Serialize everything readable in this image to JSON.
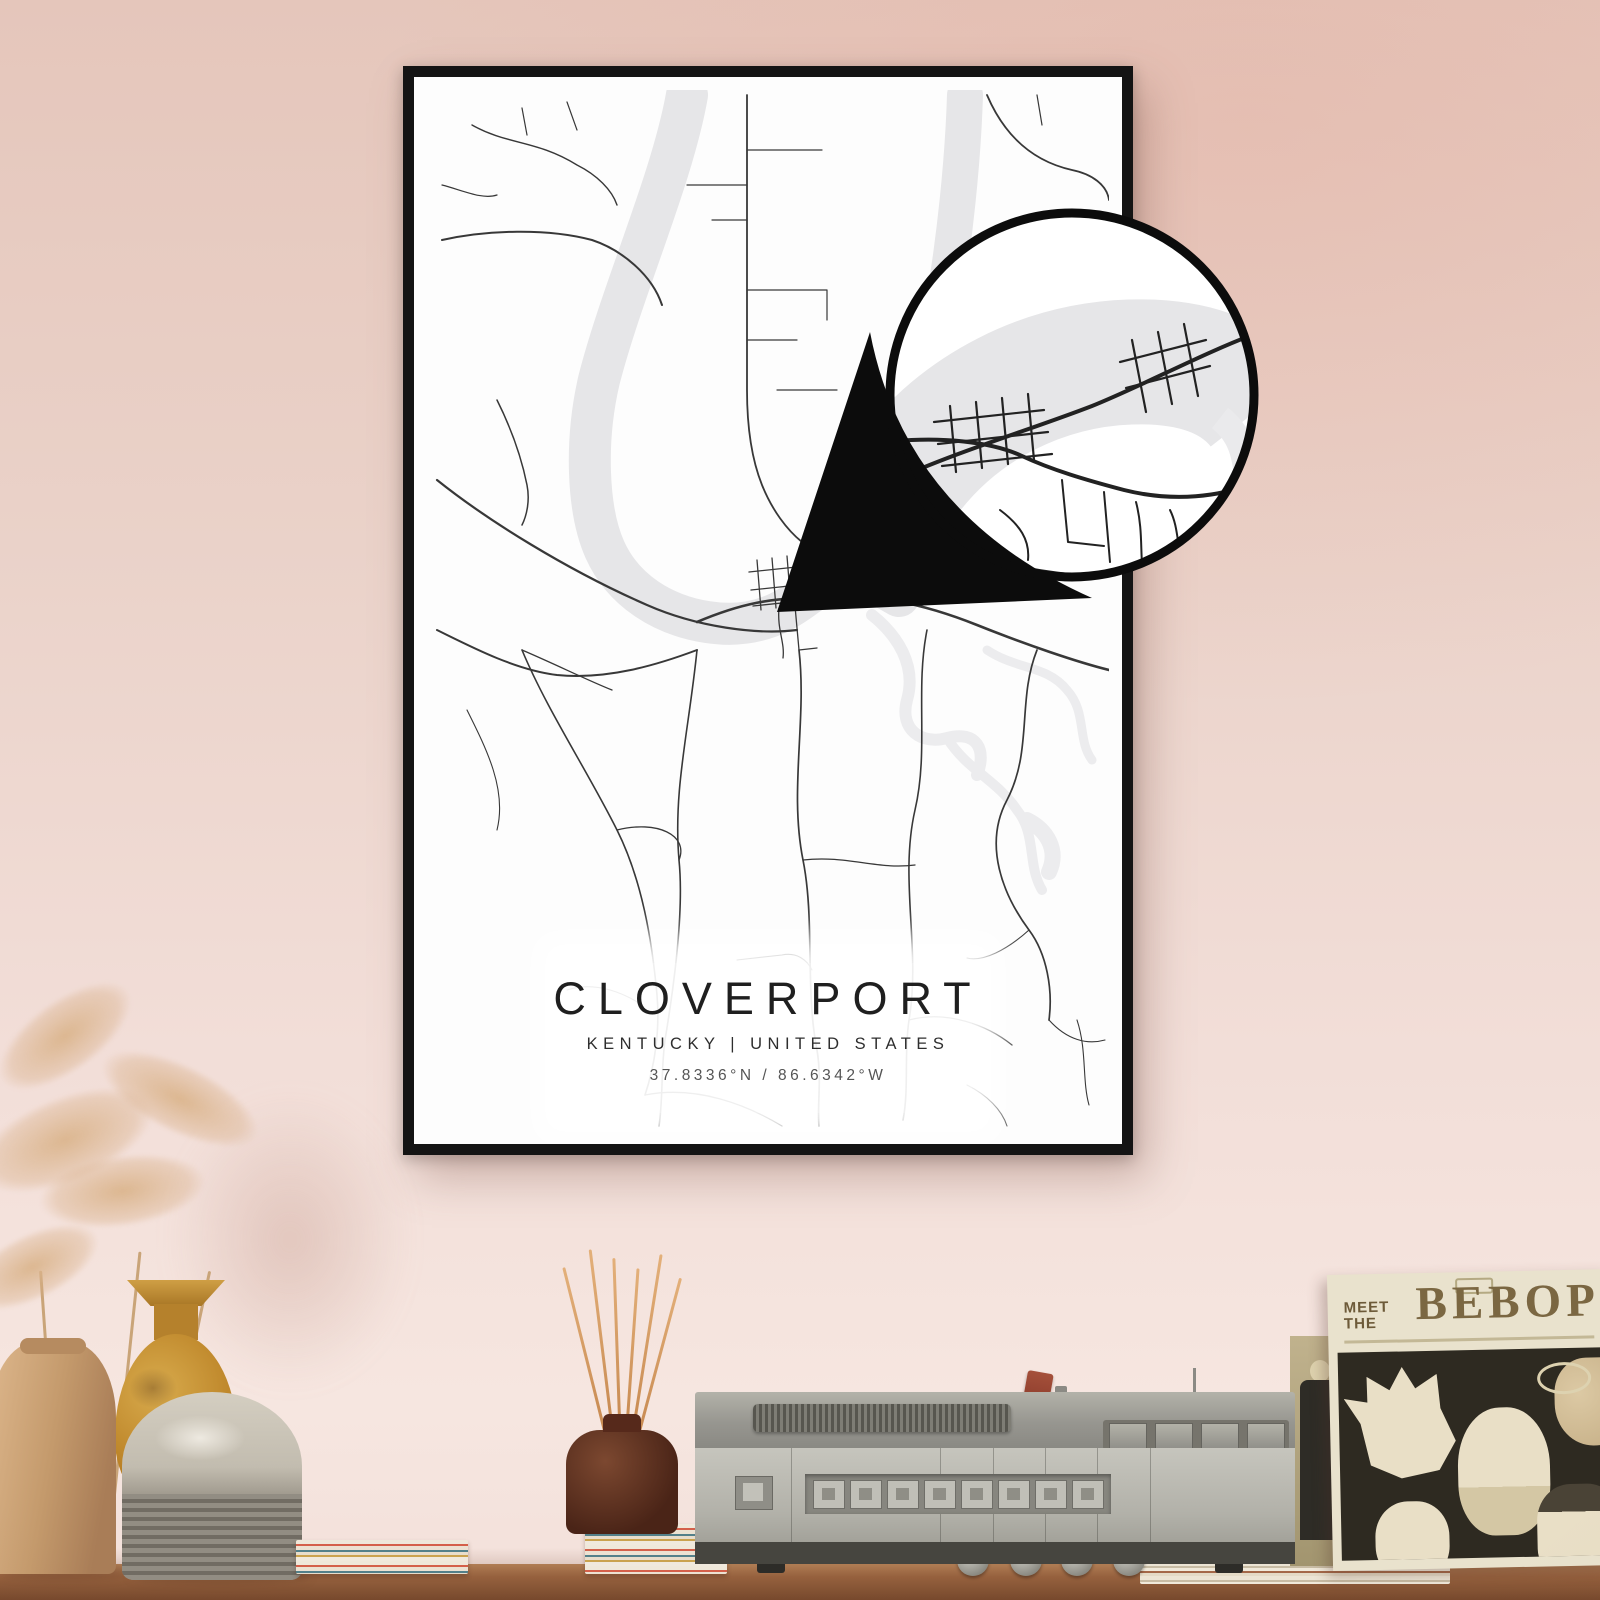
{
  "poster": {
    "title": "CLOVERPORT",
    "subtitle": "KENTUCKY | UNITED STATES",
    "coordinates": "37.8336°N / 86.6342°W"
  },
  "sleeve": {
    "meet": "MEET",
    "the": "THE",
    "bebop": "BEBOP"
  },
  "colors": {
    "wall": "#e9cec4",
    "frame": "#141414",
    "map_water": "#e6e6e8",
    "map_road": "#353535",
    "table_wood": "#96613e",
    "cartridge_red": "#9c4531",
    "sleeve_cream": "#e9e2cd",
    "sleeve_art_dark": "#2e2a21"
  }
}
